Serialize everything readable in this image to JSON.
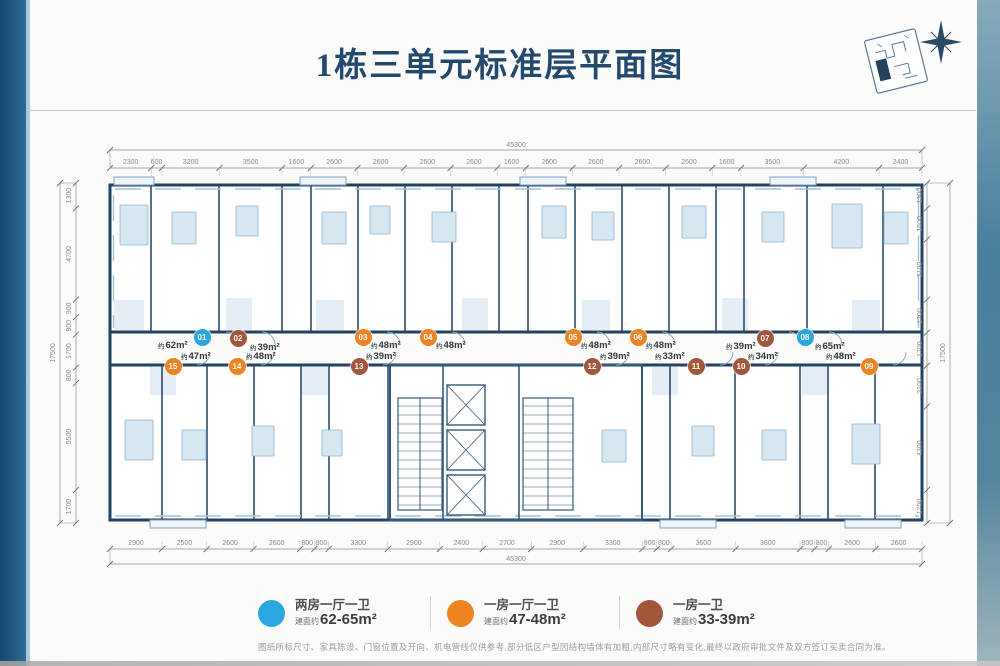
{
  "page": {
    "title": "1栋三单元标准层平面图",
    "disclaimer": "图纸所标尺寸、家具陈设、门窗位置及开向、机电管线仅供参考,部分低区户型因结构墙体有加粗,内部尺寸略有变化,最终以政府审批文件及双方签订买卖合同为准。"
  },
  "icons": {
    "site_key": "site-plan-key-icon",
    "compass": "north-compass-star-icon"
  },
  "colors": {
    "title": "#24496f",
    "wall": "#24425f",
    "unit_blue": "#2aa7de",
    "unit_orange": "#ee8322",
    "unit_brown": "#a2573d"
  },
  "dimensions": {
    "top": {
      "total": "45300",
      "segments": [
        "2300",
        "600",
        "3200",
        "3500",
        "1600",
        "2600",
        "2600",
        "2600",
        "2600",
        "1600",
        "2600",
        "2600",
        "2600",
        "2600",
        "1600",
        "3500",
        "4200",
        "2400"
      ]
    },
    "bottom": {
      "total": "45300",
      "segments": [
        "2900",
        "2500",
        "2600",
        "2600",
        "800",
        "800",
        "3300",
        "2900",
        "2400",
        "2700",
        "2900",
        "3300",
        "800",
        "800",
        "3600",
        "3600",
        "800",
        "800",
        "2600",
        "2600"
      ]
    },
    "left": {
      "total": "17500",
      "segments": [
        "1300",
        "4700",
        "900",
        "900",
        "1700",
        "800",
        "5500",
        "1700"
      ]
    },
    "right": {
      "total": "17500",
      "segments": [
        "1300",
        "1600",
        "3100",
        "1700",
        "1700",
        "2100",
        "4300",
        "1700"
      ]
    }
  },
  "units": [
    {
      "no": "01",
      "color_key": "unit_blue",
      "area_prefix": "约",
      "area_value": "62m²",
      "cx": 202,
      "cy": 337,
      "lx": 158,
      "ly": 340
    },
    {
      "no": "02",
      "color_key": "unit_brown",
      "area_prefix": "约",
      "area_value": "39m²",
      "cx": 238,
      "cy": 338,
      "lx": 250,
      "ly": 342
    },
    {
      "no": "03",
      "color_key": "unit_orange",
      "area_prefix": "约",
      "area_value": "48m²",
      "cx": 363,
      "cy": 337,
      "lx": 371,
      "ly": 340
    },
    {
      "no": "04",
      "color_key": "unit_orange",
      "area_prefix": "约",
      "area_value": "48m²",
      "cx": 428,
      "cy": 337,
      "lx": 436,
      "ly": 340
    },
    {
      "no": "05",
      "color_key": "unit_orange",
      "area_prefix": "约",
      "area_value": "48m²",
      "cx": 573,
      "cy": 337,
      "lx": 581,
      "ly": 340
    },
    {
      "no": "06",
      "color_key": "unit_orange",
      "area_prefix": "约",
      "area_value": "48m²",
      "cx": 638,
      "cy": 337,
      "lx": 646,
      "ly": 340
    },
    {
      "no": "07",
      "color_key": "unit_brown",
      "area_prefix": "约",
      "area_value": "39m²",
      "cx": 765,
      "cy": 338,
      "lx": 726,
      "ly": 341
    },
    {
      "no": "08",
      "color_key": "unit_blue",
      "area_prefix": "约",
      "area_value": "65m²",
      "cx": 805,
      "cy": 337,
      "lx": 815,
      "ly": 341
    },
    {
      "no": "09",
      "color_key": "unit_orange",
      "area_prefix": "约",
      "area_value": "48m²",
      "cx": 869,
      "cy": 366,
      "lx": 826,
      "ly": 351
    },
    {
      "no": "10",
      "color_key": "unit_brown",
      "area_prefix": "约",
      "area_value": "34m²",
      "cx": 741,
      "cy": 366,
      "lx": 748,
      "ly": 351
    },
    {
      "no": "11",
      "color_key": "unit_brown",
      "area_prefix": "约",
      "area_value": "33m²",
      "cx": 696,
      "cy": 366,
      "lx": 655,
      "ly": 351
    },
    {
      "no": "12",
      "color_key": "unit_brown",
      "area_prefix": "约",
      "area_value": "39m²",
      "cx": 592,
      "cy": 366,
      "lx": 600,
      "ly": 351
    },
    {
      "no": "13",
      "color_key": "unit_brown",
      "area_prefix": "约",
      "area_value": "39m²",
      "cx": 359,
      "cy": 366,
      "lx": 366,
      "ly": 351
    },
    {
      "no": "14",
      "color_key": "unit_orange",
      "area_prefix": "约",
      "area_value": "48m²",
      "cx": 237,
      "cy": 366,
      "lx": 246,
      "ly": 351
    },
    {
      "no": "15",
      "color_key": "unit_orange",
      "area_prefix": "约",
      "area_value": "47m²",
      "cx": 173,
      "cy": 366,
      "lx": 181,
      "ly": 351
    }
  ],
  "legend": [
    {
      "color_key": "unit_blue",
      "label": "两房一厅一卫",
      "area_prefix": "建面约",
      "area_value": "62-65m²"
    },
    {
      "color_key": "unit_orange",
      "label": "一房一厅一卫",
      "area_prefix": "建面约",
      "area_value": "47-48m²"
    },
    {
      "color_key": "unit_brown",
      "label": "一房一卫",
      "area_prefix": "建面约",
      "area_value": "33-39m²"
    }
  ]
}
